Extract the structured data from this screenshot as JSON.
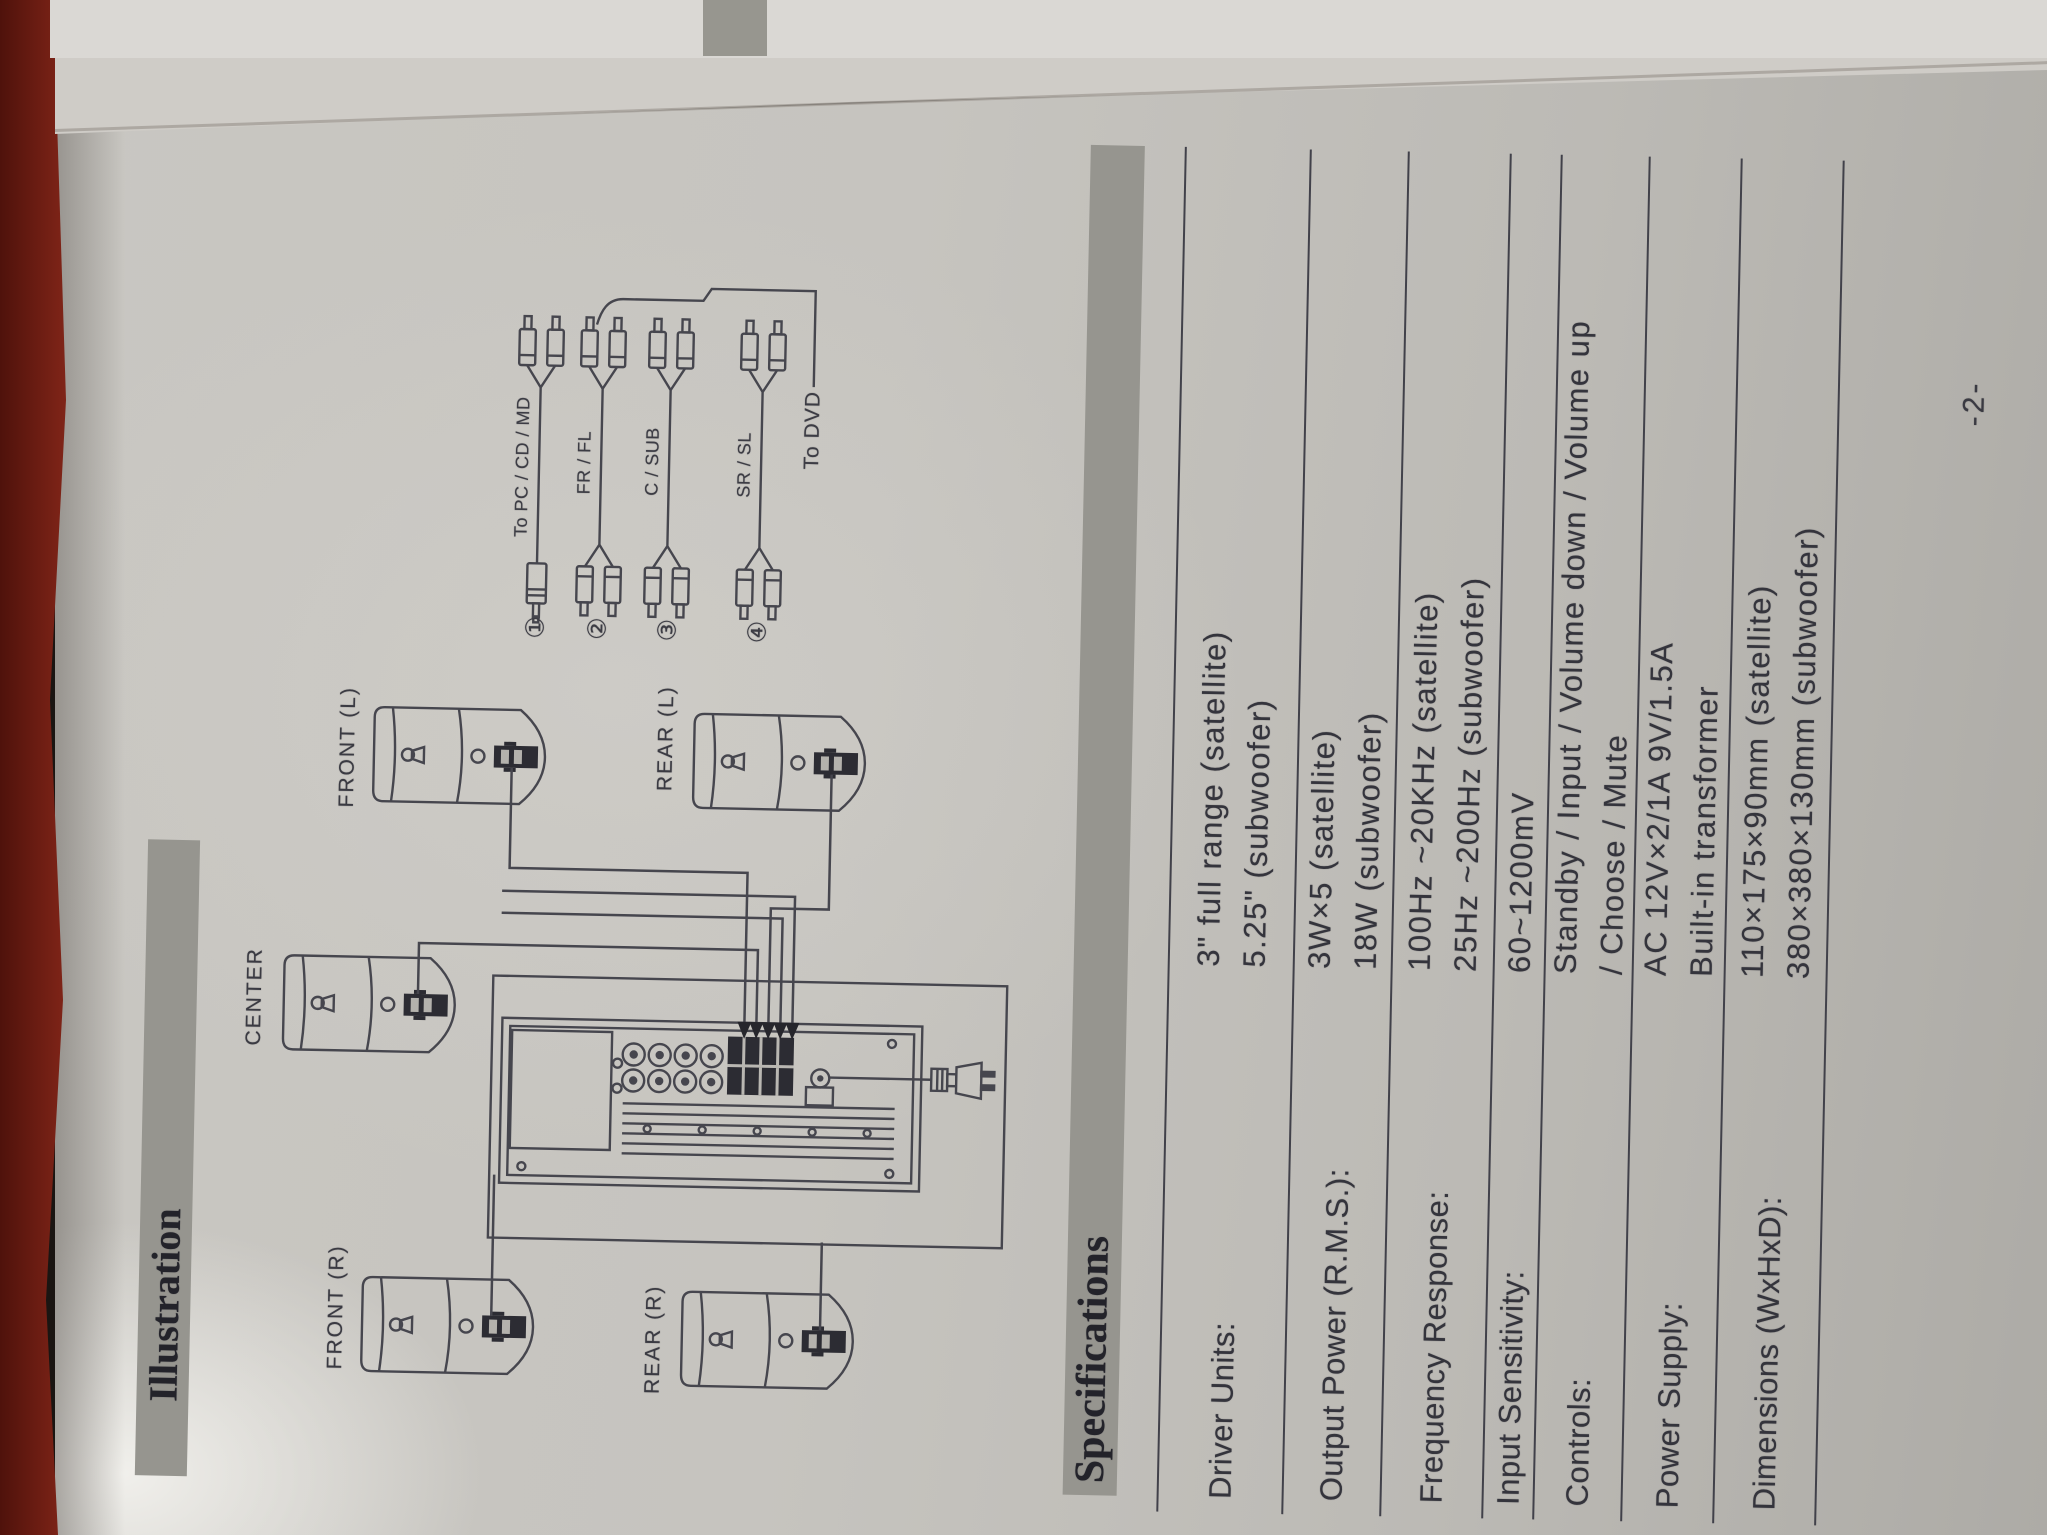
{
  "page": {
    "number": "-2-"
  },
  "illustration": {
    "header": "Illustration",
    "speakers": [
      {
        "id": "front-r",
        "label": "FRONT (R)"
      },
      {
        "id": "center",
        "label": "CENTER"
      },
      {
        "id": "front-l",
        "label": "FRONT (L)"
      },
      {
        "id": "rear-r",
        "label": "REAR (R)"
      },
      {
        "id": "rear-l",
        "label": "REAR (L)"
      }
    ],
    "cables": [
      {
        "number": "①",
        "label": "To PC / CD / MD"
      },
      {
        "number": "②",
        "label": "FR / FL"
      },
      {
        "number": "③",
        "label": "C / SUB"
      },
      {
        "number": "④",
        "label": "SR / SL"
      }
    ],
    "to_dvd_label": "To DVD"
  },
  "specifications": {
    "header": "Specifications",
    "rows": [
      {
        "label": "Driver Units:",
        "values": [
          "3\"  full range (satellite)",
          "5.25\"  (subwoofer)"
        ]
      },
      {
        "label": "Output Power (R.M.S.):",
        "values": [
          "3W×5 (satellite)",
          "18W  (subwoofer)"
        ]
      },
      {
        "label": "Frequency Response:",
        "values": [
          "100Hz ~20KHz  (satellite)",
          "25Hz ~200Hz  (subwoofer)"
        ]
      },
      {
        "label": "Input Sensitivity:",
        "values": [
          "60~1200mV"
        ]
      },
      {
        "label": "Controls:",
        "values": [
          "Standby / Input / Volume down / Volume up",
          "/ Choose / Mute"
        ]
      },
      {
        "label": "Power Supply:",
        "values": [
          "AC  12V×2/1A  9V/1.5A",
          "Built-in transformer"
        ]
      },
      {
        "label": "Dimensions (WxHxD):",
        "values": [
          "110×175×90mm (satellite)",
          "380×380×130mm (subwoofer)"
        ]
      }
    ]
  },
  "colors": {
    "paper": "#c6c4bf",
    "carpet": "#7c2317",
    "bar_gray": "#96958f",
    "ink": "#34343c"
  }
}
